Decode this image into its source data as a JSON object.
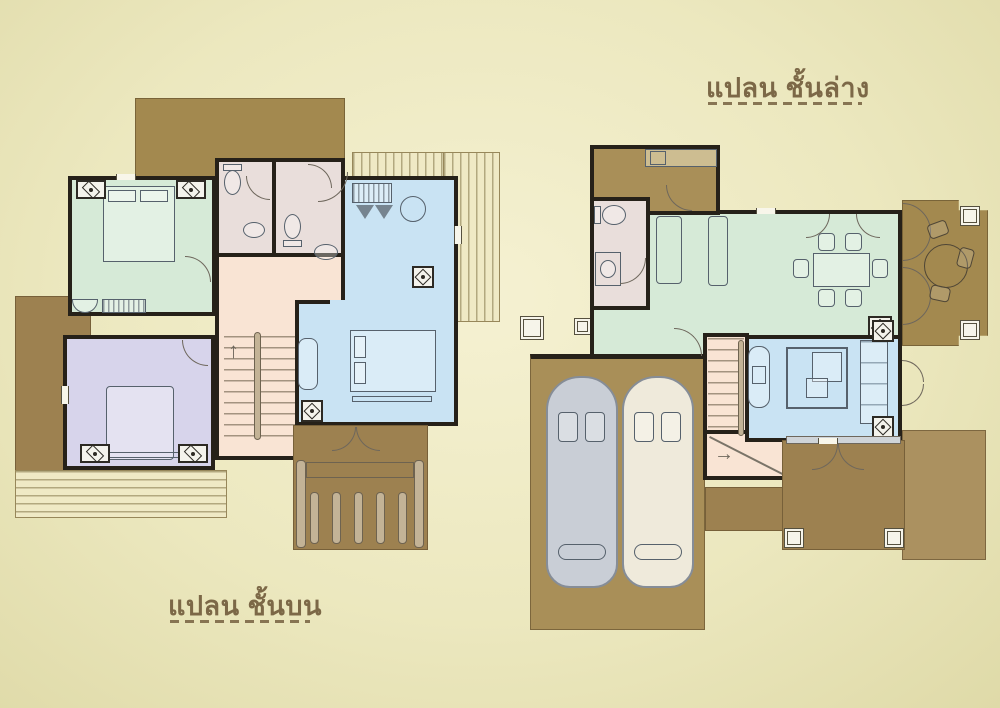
{
  "canvas": {
    "width": 1000,
    "height": 708
  },
  "labels": {
    "lower_plan": "แปลน ชั้นล่าง",
    "upper_plan": "แปลน ชั้นบน"
  },
  "icons": {
    "stairs_up_arrow": "↑",
    "stairs_right_arrow": "→"
  },
  "colors": {
    "wall": "#262119",
    "label": "#7c6847",
    "wood1": "#a3894f",
    "wood2": "#9d8150",
    "wood3": "#a98f58",
    "deck": "#efe9c5",
    "green": "#d6ead7",
    "blue": "#c9e3f3",
    "purple": "#d7d4eb",
    "pink": "#f9e4d4",
    "bath": "#e9dedb",
    "furn": "#56616c",
    "car_gray": "#c9ced6",
    "car_cream": "#efeadb"
  }
}
